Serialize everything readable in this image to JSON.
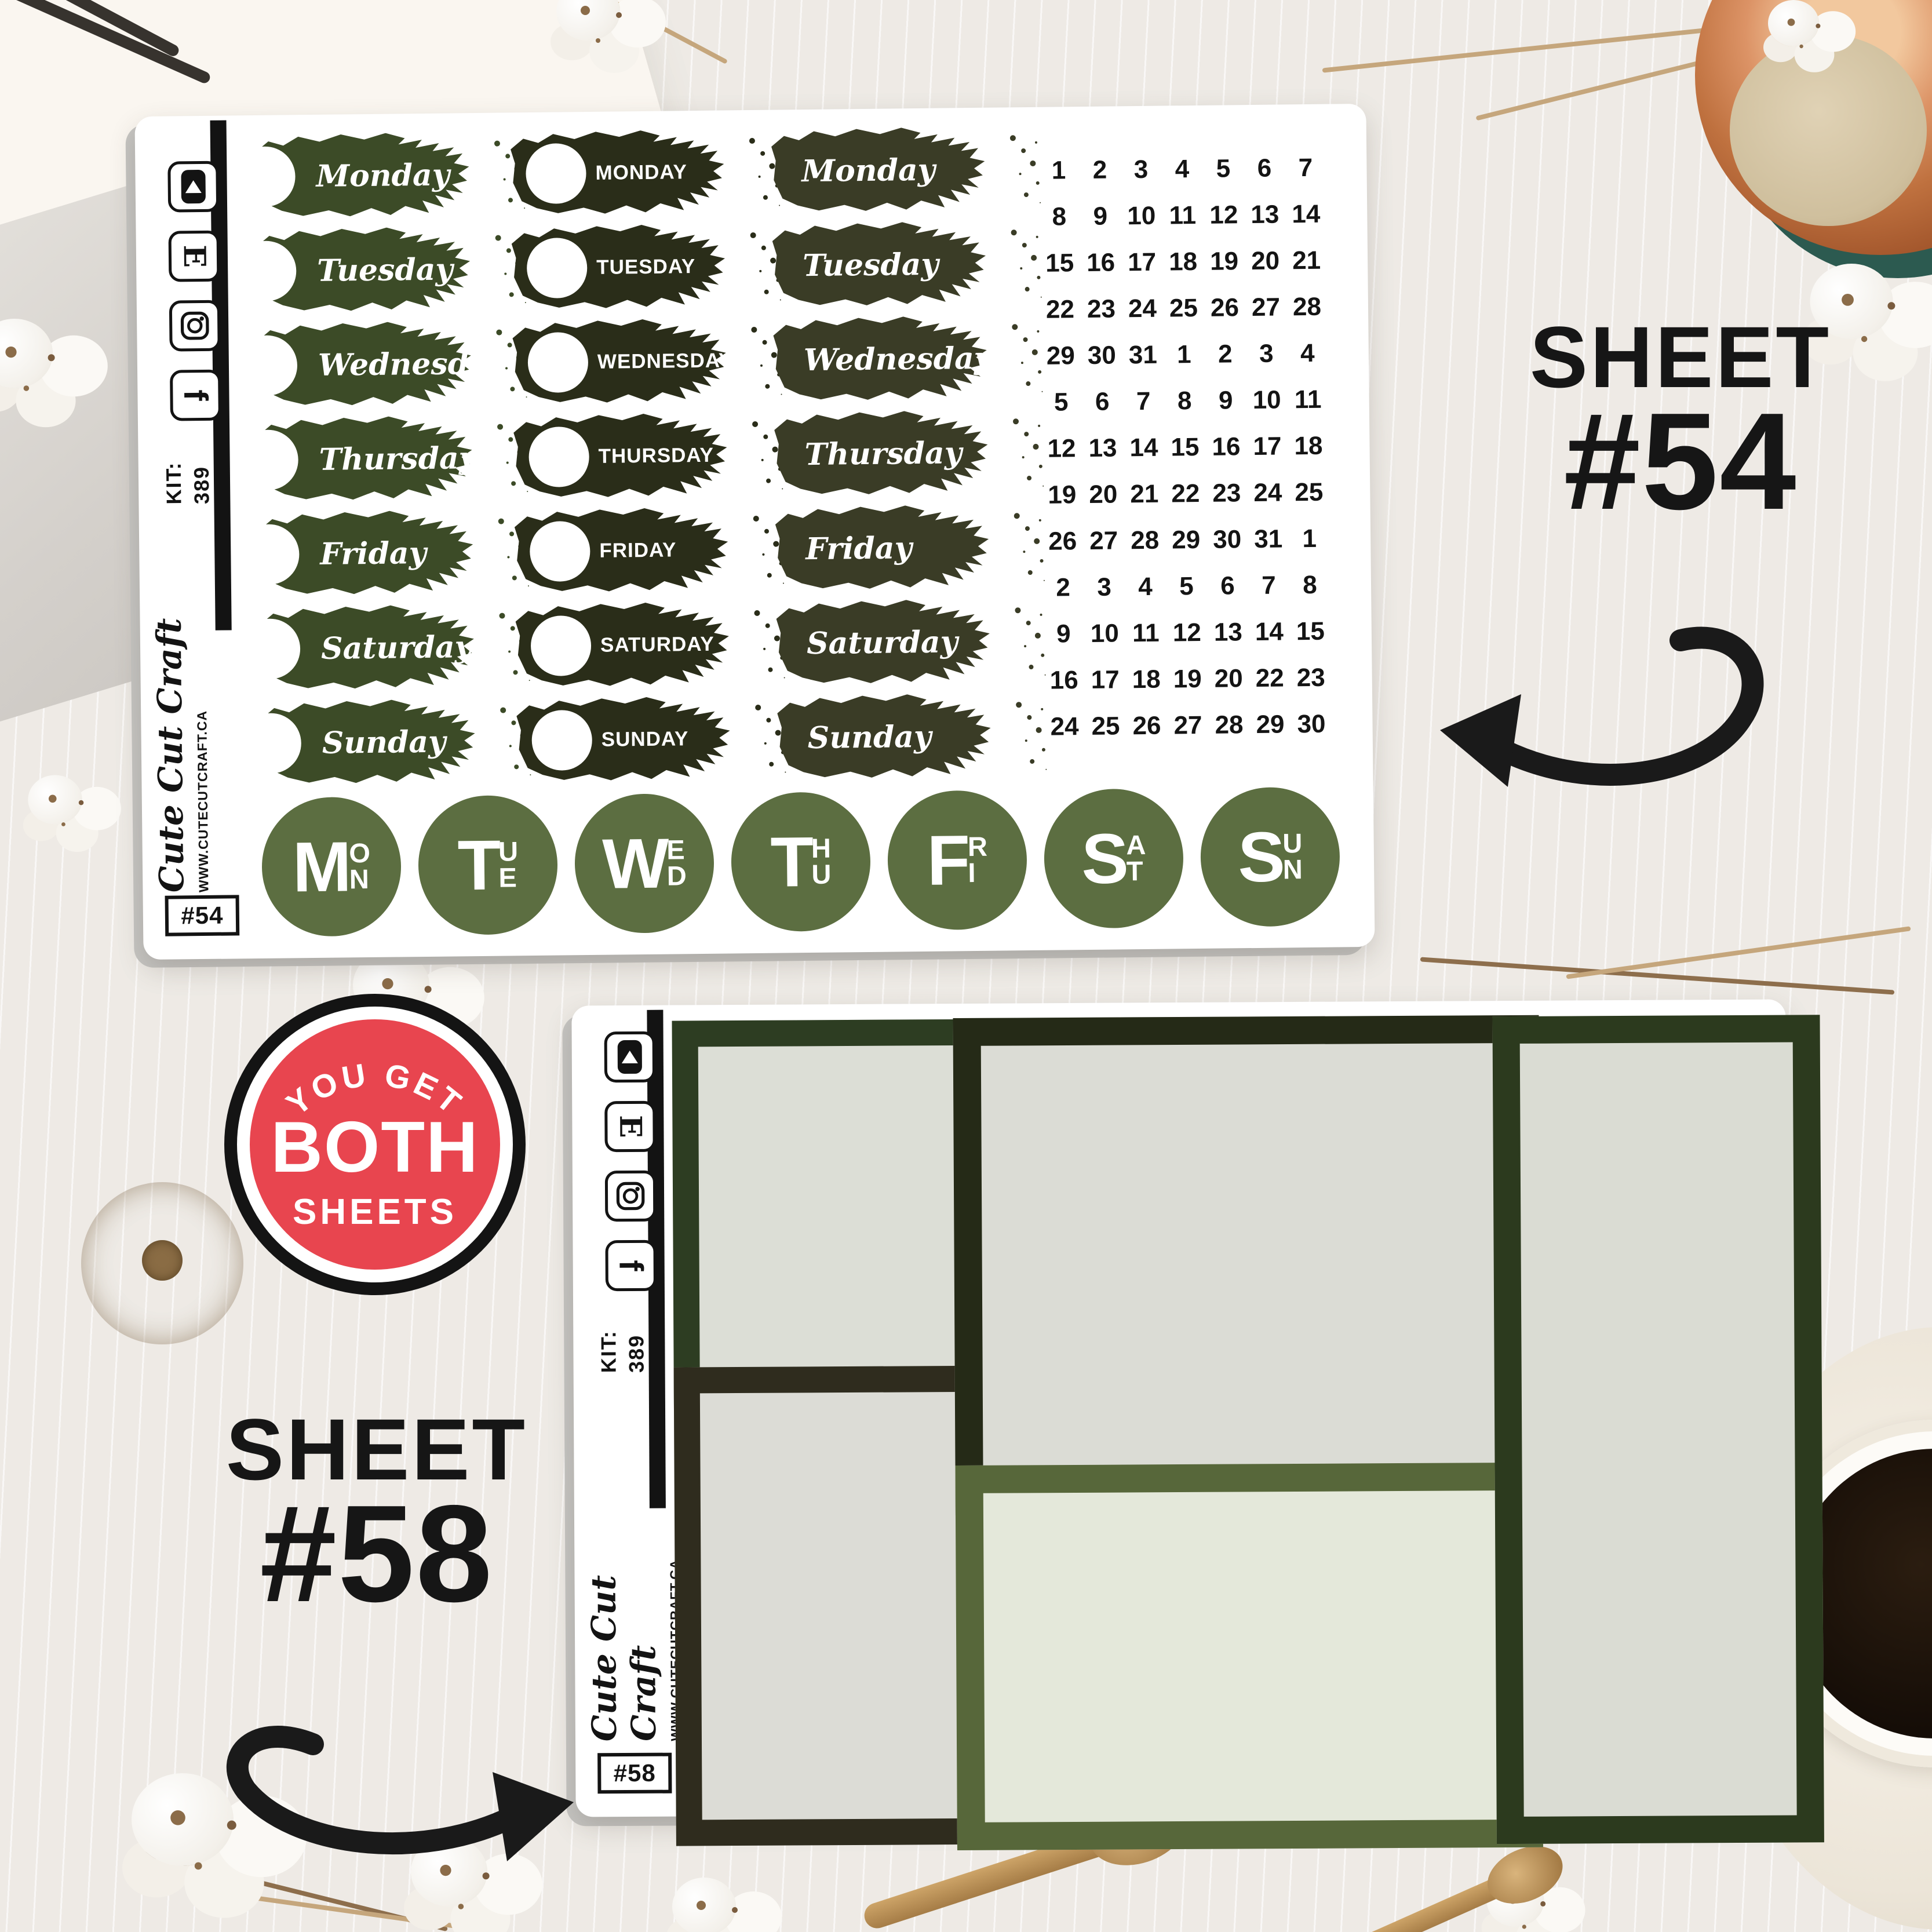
{
  "badge": {
    "top": "YOU GET",
    "middle": "BOTH",
    "bottom": "SHEETS",
    "red": "#e8454f"
  },
  "callouts": {
    "s54": {
      "word": "SHEET",
      "num": "#54"
    },
    "s58": {
      "word": "SHEET",
      "num": "#58"
    }
  },
  "sheet54": {
    "sidebar": {
      "icons": [
        "play-icon",
        "etsy-icon",
        "instagram-icon",
        "facebook-icon"
      ],
      "etsy_glyph": "E",
      "facebook_glyph": "f",
      "kit_label": "KIT:",
      "kit_number": "389",
      "logo": "Cute Cut Craft",
      "website": "WWW.CUTECUTCRAFT.CA",
      "tag": "#54"
    },
    "columns": {
      "script_circle": [
        "Monday",
        "Tuesday",
        "Wednesday",
        "Thursday",
        "Friday",
        "Saturday",
        "Sunday"
      ],
      "caps_circle": [
        "MONDAY",
        "TUESDAY",
        "WEDNESDAY",
        "THURSDAY",
        "FRIDAY",
        "SATURDAY",
        "SUNDAY"
      ],
      "script_plain": [
        "Monday",
        "Tuesday",
        "Wednesday",
        "Thursday",
        "Friday",
        "Saturday",
        "Sunday"
      ]
    },
    "date_grid": [
      [
        1,
        2,
        3,
        4,
        5,
        6,
        7
      ],
      [
        8,
        9,
        10,
        11,
        12,
        13,
        14
      ],
      [
        15,
        16,
        17,
        18,
        19,
        20,
        21
      ],
      [
        22,
        23,
        24,
        25,
        26,
        27,
        28
      ],
      [
        29,
        30,
        31,
        1,
        2,
        3,
        4
      ],
      [
        5,
        6,
        7,
        8,
        9,
        10,
        11
      ],
      [
        12,
        13,
        14,
        15,
        16,
        17,
        18
      ],
      [
        19,
        20,
        21,
        22,
        23,
        24,
        25
      ],
      [
        26,
        27,
        28,
        29,
        30,
        31,
        1
      ],
      [
        2,
        3,
        4,
        5,
        6,
        7,
        8
      ],
      [
        9,
        10,
        11,
        12,
        13,
        14,
        15
      ],
      [
        16,
        17,
        18,
        19,
        20,
        22,
        23
      ],
      [
        24,
        25,
        26,
        27,
        28,
        29,
        30
      ]
    ],
    "day_dots": [
      "MON",
      "TUE",
      "WED",
      "THU",
      "FRI",
      "SAT",
      "SUN"
    ],
    "colors": {
      "script_circle": "#3c4b27",
      "caps_circle": "#2a2d19",
      "script_plain": "#3a3c26",
      "dot": "#5c6e41"
    }
  },
  "sheet58": {
    "sidebar": {
      "icons": [
        "play-icon",
        "etsy-icon",
        "instagram-icon",
        "facebook-icon"
      ],
      "etsy_glyph": "E",
      "facebook_glyph": "f",
      "kit_label": "KIT:",
      "kit_number": "389",
      "logo": "Cute Cut Craft",
      "website": "WWW.CUTECUTCRAFT.CA",
      "tag": "#58"
    },
    "boxes": [
      {
        "name": "left-top",
        "border": "#2d3d22",
        "fill": "#dcded6"
      },
      {
        "name": "left-bottom",
        "border": "#2f2c1e",
        "fill": "#dcdcd6"
      },
      {
        "name": "mid-top",
        "border": "#252a17",
        "fill": "#dbdcd5"
      },
      {
        "name": "mid-bottom",
        "border": "#57673a",
        "fill": "#e4e8da"
      },
      {
        "name": "right",
        "border": "#2c3a1e",
        "fill": "#dadcd3"
      }
    ]
  }
}
